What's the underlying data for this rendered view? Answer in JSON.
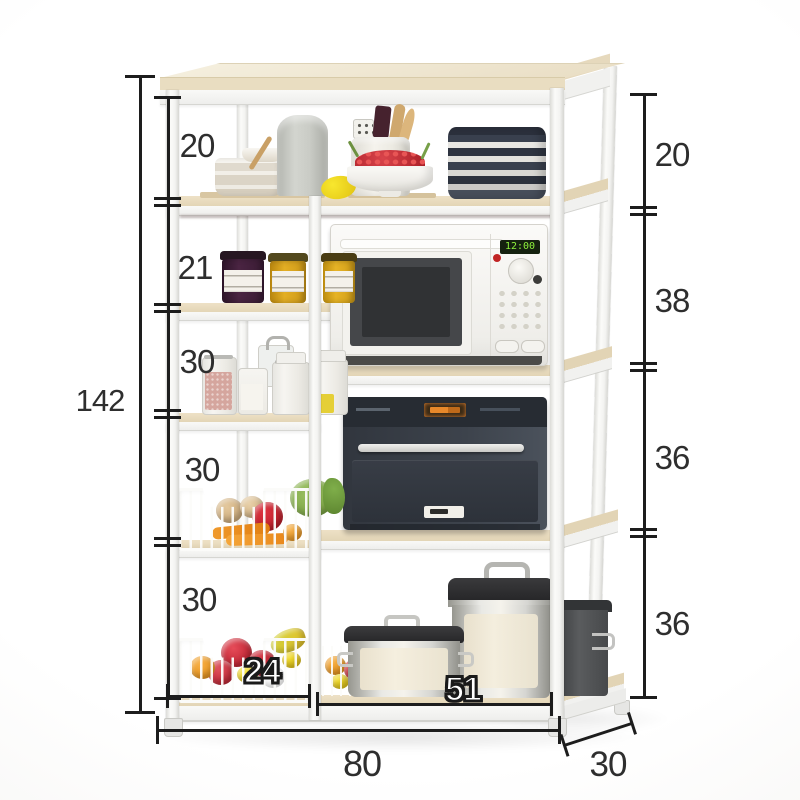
{
  "annotations": {
    "total_height": "142",
    "left_gaps": [
      "20",
      "21",
      "30",
      "30",
      "30"
    ],
    "right_gaps": [
      "20",
      "38",
      "36",
      "36"
    ],
    "bottom_left_width": "24",
    "bottom_right_width": "51",
    "total_width": "80",
    "depth": "30"
  },
  "appliances": {
    "microwave_display": "12:00"
  },
  "colors": {
    "dimension_line": "#1d1d1d",
    "dimension_text": "#2e2e2e",
    "wood_shelf": "#e9dcc0",
    "frame_white": "#f6f6f4",
    "microwave_display_green": "#8df03c",
    "oven_display_orange": "#e08030",
    "apple_red": "#d6303f",
    "carrot_orange": "#ee8a1f",
    "lemon_yellow": "#f2d820"
  }
}
